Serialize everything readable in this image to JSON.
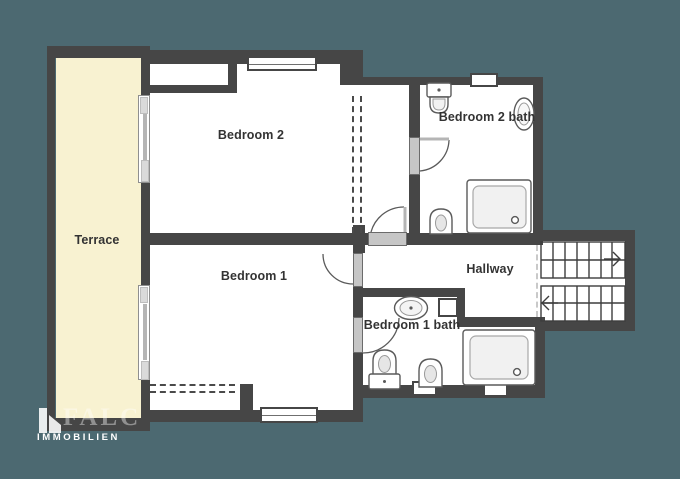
{
  "plan": {
    "type": "floor-plan",
    "floor": "upper floor with two bedrooms, two baths, hallway with U-stairs and terrace",
    "rooms": [
      {
        "id": "terrace",
        "label": "Terrace"
      },
      {
        "id": "bedroom-2",
        "label": "Bedroom 2"
      },
      {
        "id": "bedroom-2-bath",
        "label": "Bedroom 2 bath"
      },
      {
        "id": "bedroom-1",
        "label": "Bedroom 1"
      },
      {
        "id": "hallway",
        "label": "Hallway"
      },
      {
        "id": "bedroom-1-bath",
        "label": "Bedroom 1 bath"
      }
    ],
    "fixtures": {
      "bedroom_2_bath": [
        "wash-basin",
        "oval-basin",
        "door",
        "toilet",
        "shower-tray",
        "window"
      ],
      "bedroom_1_bath": [
        "wash-basin",
        "shaft",
        "toilet-with-cistern",
        "toilet",
        "shower-tray",
        "two-windows",
        "door"
      ],
      "stairs": {
        "flights": 2,
        "arrows": [
          "up-right",
          "down-left"
        ]
      }
    },
    "colors": {
      "background": "#4c6971",
      "wall": "#464646",
      "room": "#ffffff",
      "terrace": "#f8f2d1",
      "door": "#c6c6c6",
      "label_text": "#333333"
    }
  },
  "logo": {
    "brand": "FALC",
    "subtitle": "IMMOBILIEN"
  }
}
